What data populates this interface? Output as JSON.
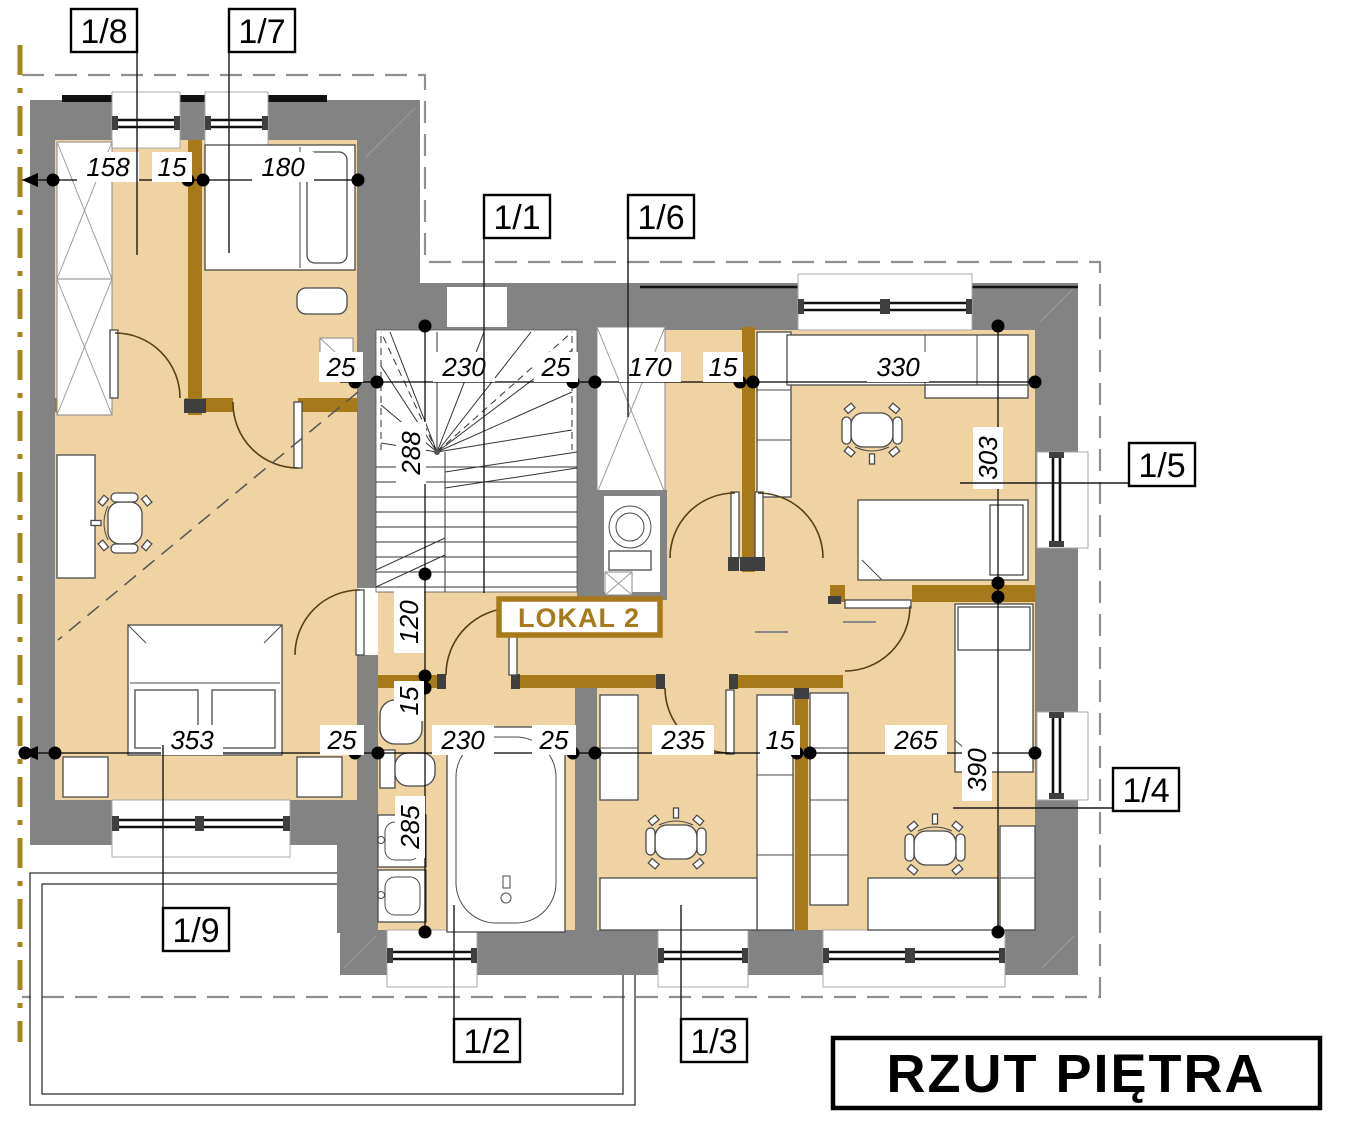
{
  "labels": {
    "unit": "LOKAL 2",
    "title": "RZUT PIĘTRA"
  },
  "room_tags": [
    "1/1",
    "1/2",
    "1/3",
    "1/4",
    "1/5",
    "1/6",
    "1/7",
    "1/8",
    "1/9"
  ],
  "dimensions": {
    "top": [
      "158",
      "15",
      "180"
    ],
    "middle": [
      "25",
      "230",
      "25",
      "170",
      "15",
      "330"
    ],
    "bottom": [
      "353",
      "25",
      "230",
      "25",
      "235",
      "15",
      "265"
    ],
    "vertical": [
      "288",
      "120",
      "15",
      "285",
      "303",
      "390"
    ]
  },
  "colors": {
    "floor": "#EFD3A2",
    "wall": "#838383",
    "wood": "#A6791B",
    "boundary": "#A8861D"
  }
}
